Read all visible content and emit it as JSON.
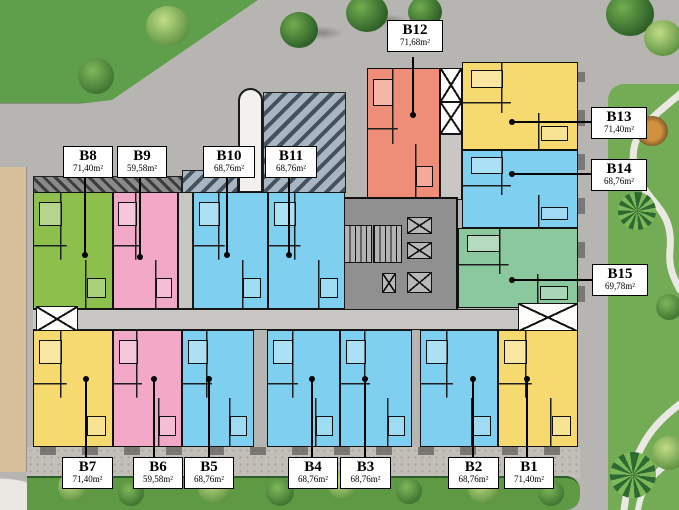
{
  "units": [
    {
      "name": "B1",
      "area": "71,40m²",
      "color": "#f6d96f"
    },
    {
      "name": "B2",
      "area": "68,76m²",
      "color": "#7fd0f0"
    },
    {
      "name": "B3",
      "area": "68,76m²",
      "color": "#7fd0f0"
    },
    {
      "name": "B4",
      "area": "68,76m²",
      "color": "#7fd0f0"
    },
    {
      "name": "B5",
      "area": "68,76m²",
      "color": "#7fd0f0"
    },
    {
      "name": "B6",
      "area": "59,58m²",
      "color": "#f2a9c7"
    },
    {
      "name": "B7",
      "area": "71,40m²",
      "color": "#f6d96f"
    },
    {
      "name": "B8",
      "area": "71,40m²",
      "color": "#8dbf4d"
    },
    {
      "name": "B9",
      "area": "59,58m²",
      "color": "#f2a9c7"
    },
    {
      "name": "B10",
      "area": "68,76m²",
      "color": "#7fd0f0"
    },
    {
      "name": "B11",
      "area": "68,76m²",
      "color": "#7fd0f0"
    },
    {
      "name": "B12",
      "area": "71,68m²",
      "color": "#ef8e78"
    },
    {
      "name": "B13",
      "area": "71,40m²",
      "color": "#f6d96f"
    },
    {
      "name": "B14",
      "area": "68,76m²",
      "color": "#7fd0f0"
    },
    {
      "name": "B15",
      "area": "69,78m²",
      "color": "#8cc89e"
    }
  ],
  "colors": {
    "road_gray": "#b7b5b1",
    "corridor_gray": "#c9c7c3",
    "core_gray": "#909090",
    "grass_green": "#5f9f4b",
    "park_green": "#73ac55",
    "hedge_green": "#5d9a43",
    "path_tan": "#d8bf9b",
    "label_bg": "#ffffff",
    "wall_black": "#111111"
  }
}
